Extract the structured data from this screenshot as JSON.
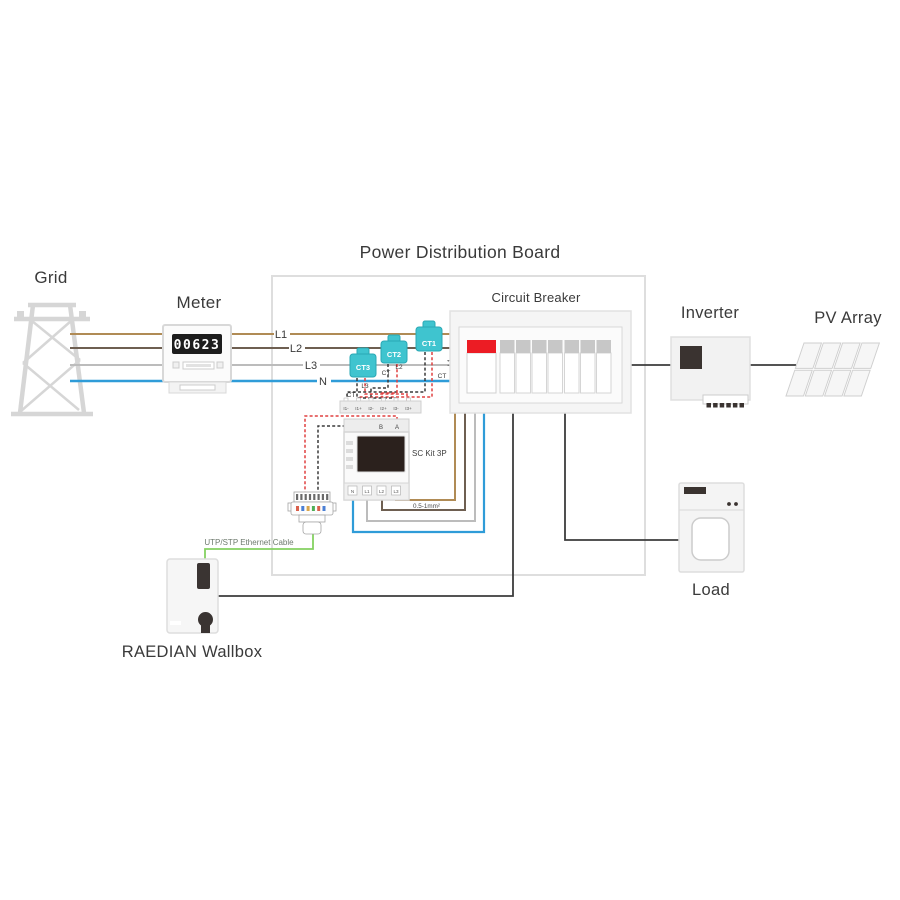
{
  "title": "Power Distribution Board",
  "grid": {
    "label": "Grid"
  },
  "meter": {
    "label": "Meter",
    "reading": "00623"
  },
  "lines": {
    "l1": "L1",
    "l2": "L2",
    "l3": "L3",
    "n": "N"
  },
  "breaker": {
    "label": "Circuit Breaker",
    "module_count": 8
  },
  "inverter": {
    "label": "Inverter"
  },
  "pv": {
    "label": "PV Array"
  },
  "load": {
    "label": "Load"
  },
  "wallbox": {
    "label": "RAEDIAN Wallbox"
  },
  "ethernet": {
    "label": "UTP/STP Ethernet Cable"
  },
  "sckit": {
    "label": "SC Kit 3P",
    "wire_gauge": "0.5-1mm²",
    "ct_terminals": [
      "I1-",
      "I1+",
      "I2-",
      "I2+",
      "I3-",
      "I3+"
    ],
    "comm_terminals": [
      "B",
      "A"
    ],
    "power_terminals": [
      "N",
      "L1",
      "L2",
      "L3"
    ]
  },
  "cts": [
    {
      "name": "CT1",
      "line": "L1",
      "tag": "CT"
    },
    {
      "name": "CT2",
      "line": "L2",
      "tag": "CT"
    },
    {
      "name": "CT3",
      "line": "L3",
      "tag": "CT"
    }
  ],
  "colors": {
    "l1_wire": "#b08b55",
    "l2_wire": "#6e5f51",
    "l3_wire": "#bcbcbc",
    "n_wire": "#2f9cd8",
    "ct_clamp": "#3fc4cf",
    "breaker_red": "#ec1c24",
    "ethernet_green": "#84d161",
    "dashed_red": "#e04040",
    "dashed_black": "#3a3a3a",
    "wire_black": "#3c3c3c"
  }
}
